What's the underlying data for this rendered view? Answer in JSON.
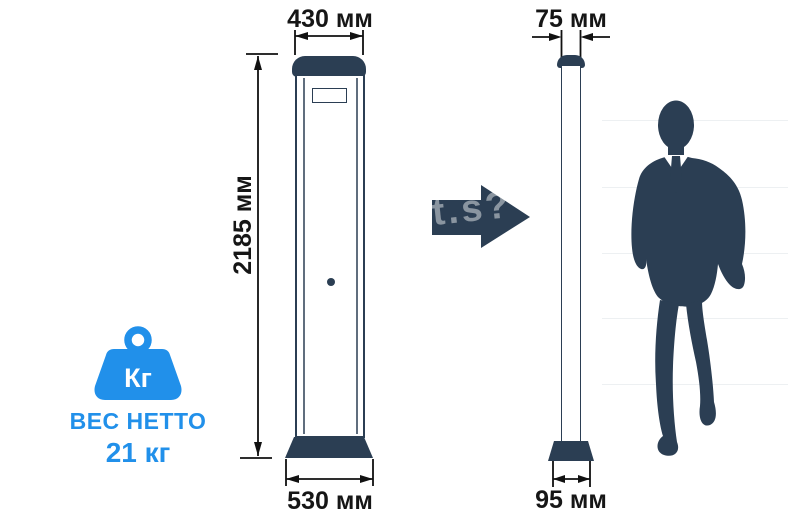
{
  "weight": {
    "icon": "kettlebell-weight-icon",
    "icon_label": "Кг",
    "title": "ВЕС НЕТТО",
    "value": "21 кг"
  },
  "front_view": {
    "top_width": "430 мм",
    "height": "2185 мм",
    "base_width": "530 мм"
  },
  "side_view": {
    "top_width": "75 мм",
    "base_width": "95 мм"
  },
  "watermark": {
    "fragment": "t.s?"
  },
  "colors": {
    "navy": "#2b3e53",
    "accent_blue": "#2190ea",
    "dimension_line": "#111111",
    "gridline": "#edf0f2"
  }
}
